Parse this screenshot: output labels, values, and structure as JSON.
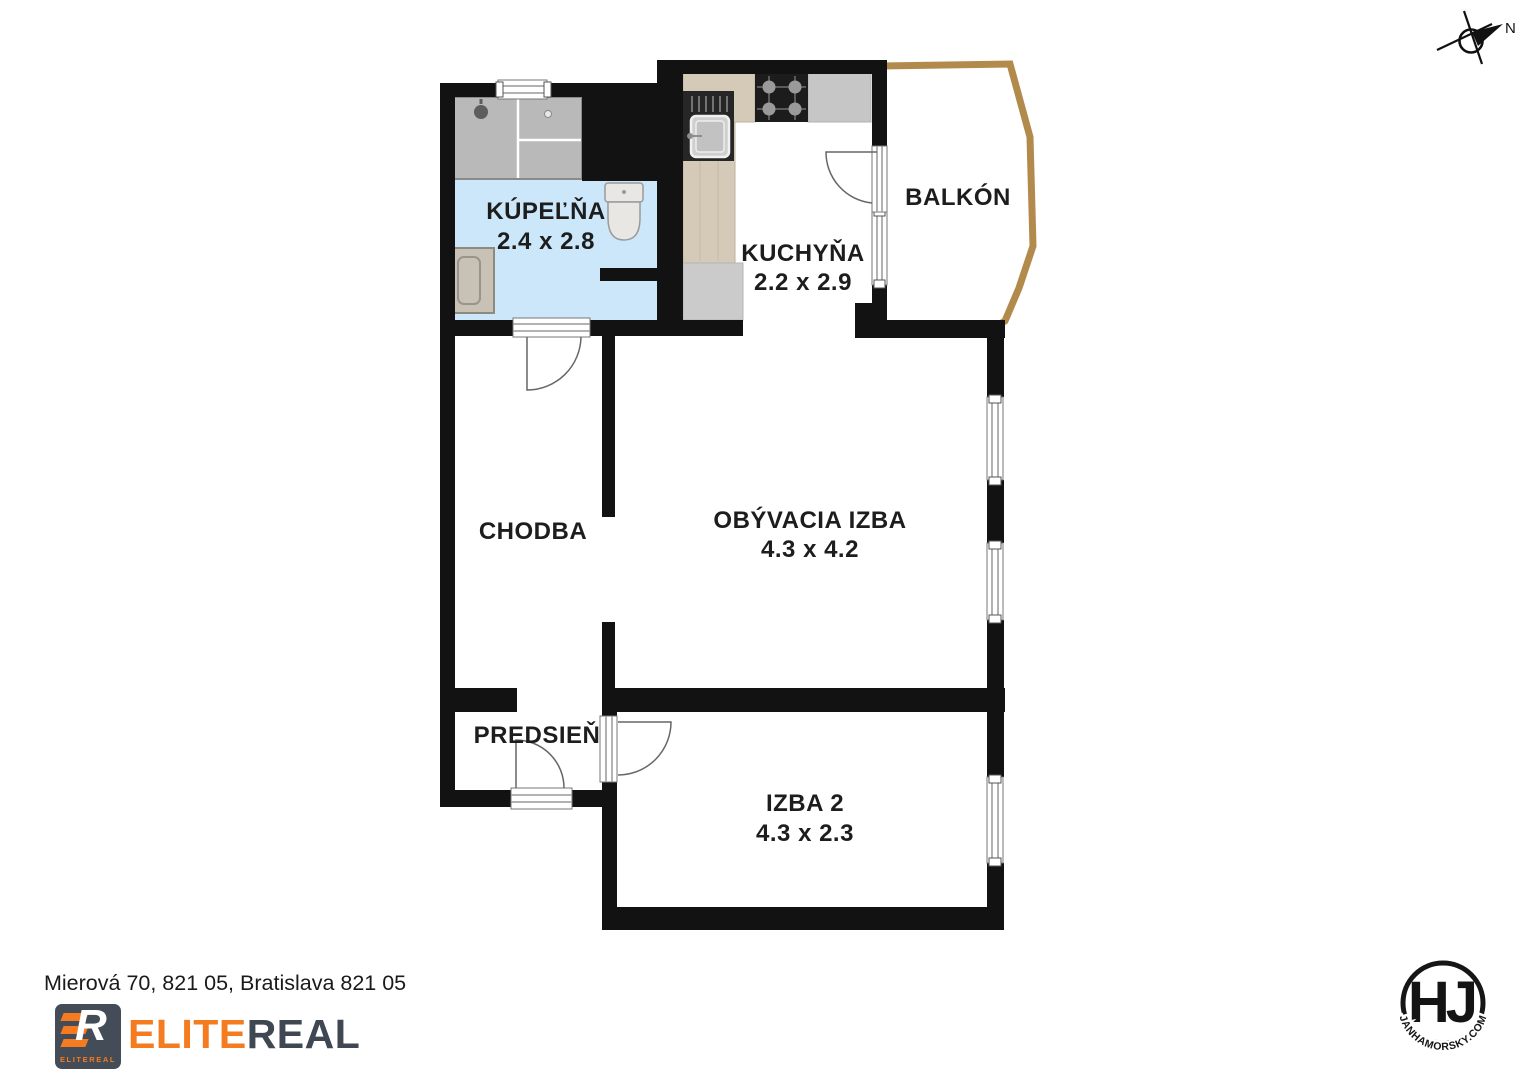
{
  "compass": {
    "north_label": "N"
  },
  "plan": {
    "rooms": {
      "kupelna": {
        "name": "KÚPEĽŇA",
        "dims": "2.4 x 2.8"
      },
      "kuchyna": {
        "name": "KUCHYŇA",
        "dims": "2.2 x 2.9"
      },
      "balkon": {
        "name": "BALKÓN"
      },
      "chodba": {
        "name": "CHODBA"
      },
      "obyvacia": {
        "name": "OBÝVACIA IZBA",
        "dims": "4.3 x 4.2"
      },
      "predsien": {
        "name": "PREDSIEŇ"
      },
      "izba2": {
        "name": "IZBA 2",
        "dims": "4.3 x 2.3"
      }
    },
    "colors": {
      "wall": "#121212",
      "bathroom_floor": "#cbe7f9",
      "shower_tile": "#b9b9b9",
      "counter_wood": "#d4cab7",
      "counter_gray": "#c6c6c6",
      "balcony_outline": "#b28a4b"
    }
  },
  "footer": {
    "address": "Mierová 70, 821 05, Bratislava 821 05",
    "brand": {
      "icon_letter": "R",
      "icon_label": "ELITEREAL",
      "name_part1": "ELITE",
      "name_part2": "REAL",
      "orange": "#f47b20",
      "dark": "#3f4752"
    }
  },
  "credit": {
    "monogram": "HJ",
    "site": "JANHAMORSKY.COM"
  }
}
